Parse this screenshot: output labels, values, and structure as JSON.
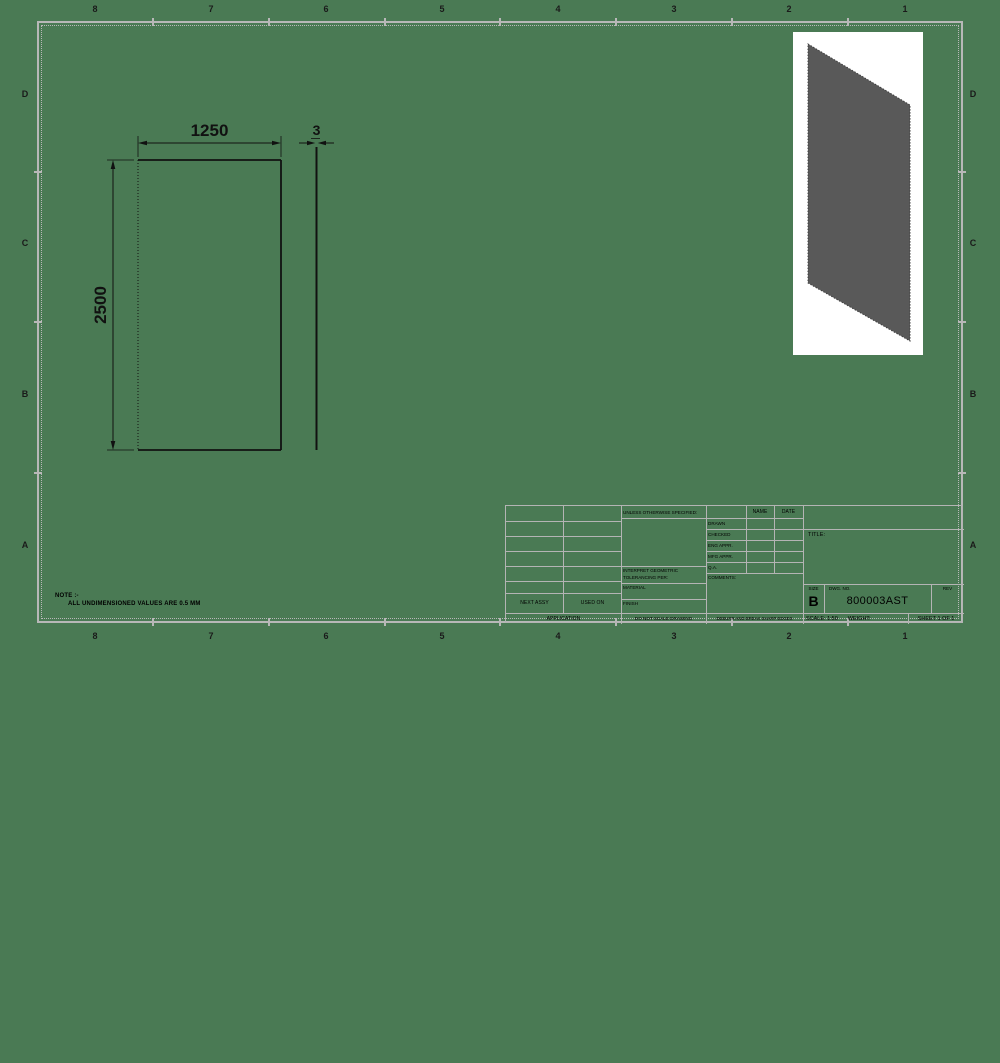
{
  "sheet": {
    "bg_color": "#4a7a54",
    "frame_color": "#b8b8b8",
    "zone_cols": [
      "8",
      "7",
      "6",
      "5",
      "4",
      "3",
      "2",
      "1"
    ],
    "zone_rows": [
      "D",
      "C",
      "B",
      "A"
    ]
  },
  "note": {
    "line1": "NOTE :-",
    "line2": "ALL UNDIMENSIONED VALUES ARE 0.5 MM"
  },
  "views": {
    "front": {
      "width_dim": "1250",
      "height_dim": "2500"
    },
    "side": {
      "thickness_dim": "3"
    },
    "iso": {
      "plate_color": "#595959",
      "card_color": "#ffffff"
    }
  },
  "title_block": {
    "application": {
      "next_assy": "NEXT ASSY",
      "used_on": "USED ON",
      "application": "APPLICATION"
    },
    "tolerance": {
      "header": "UNLESS OTHERWISE SPECIFIED:",
      "lines": [
        "DIMENSIONS ARE IN MILLIMETERS",
        "TOLERANCES:",
        "FRACTIONAL±",
        "ANGULAR: MACH±  BEND ±",
        "TWO PLACE DECIMAL    ±",
        "THREE PLACE DECIMAL  ±"
      ],
      "interpret1": "INTERPRET GEOMETRIC",
      "interpret2": "TOLERANCING PER:",
      "material": "MATERIAL",
      "finish": "FINISH",
      "do_not_scale": "DO NOT SCALE DRAWING"
    },
    "approvals": {
      "name_header": "NAME",
      "date_header": "DATE",
      "rows": [
        "DRAWN",
        "CHECKED",
        "ENG APPR.",
        "MFG APPR.",
        "Q.A."
      ],
      "comments": "COMMENTS:",
      "deburr": "DEBURR AND BREAK SHARP EDGES"
    },
    "title_label": "TITLE:",
    "size_label": "SIZE",
    "size_value": "B",
    "dwg_no_label": "DWG.  NO.",
    "dwg_no_value": "800003AST",
    "rev_label": "REV",
    "scale_text": "SCALE: 1:50",
    "weight_text": "WEIGHT:",
    "sheet_text": "SHEET 1 OF 1"
  }
}
